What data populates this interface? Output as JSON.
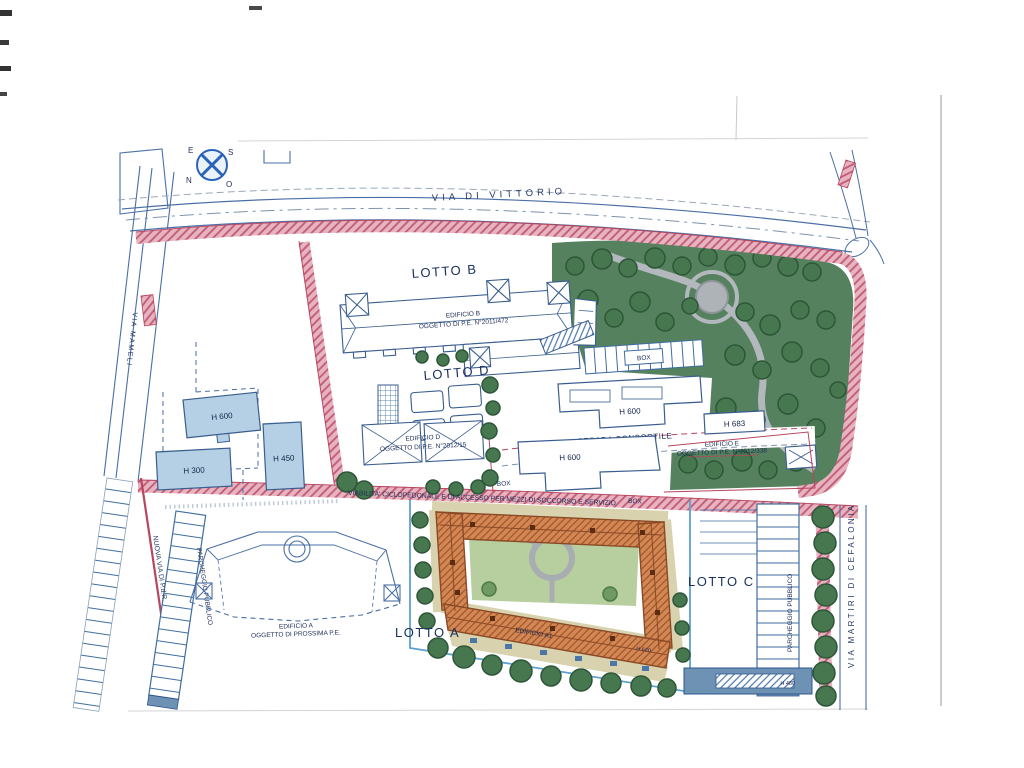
{
  "colors": {
    "ink_blue": "#3a5d8f",
    "faint_ink": "#7d93ad",
    "red_line": "#b8465e",
    "park_green": "#55815f",
    "tree_green": "#47774f",
    "path_pink": "#e6b3c1",
    "existing_building_blue": "#b5d0e4",
    "roof_orange": "#d28756",
    "terrace_tan": "#d9d2ae",
    "courtyard_green": "#b7cf9e",
    "walk_gray": "#b3b8bd",
    "strip_blue": "#6d92b4"
  },
  "compass": {
    "east": "E",
    "south": "S",
    "north": "N",
    "west": "O"
  },
  "streets": {
    "via_di_vittorio": "VIA  DI  VITTORIO",
    "via_mameli": "VIA  MAMELI",
    "nuova_via": "NUOVA  VIA  DI  P.d.R.",
    "via_martiri": "VIA  MARTIRI  DI  CEFALONIA",
    "strada_consortile": "STRADA CONSORTILE",
    "viabilita": "VIABILITA' CICLOPEDONALE E DI ACCESSO PER MEZZI DI SOCCORSO E SERVIZIO"
  },
  "lots": {
    "a": "LOTTO A",
    "b": "LOTTO B",
    "c": "LOTTO C",
    "d": "LOTTO D"
  },
  "buildings": {
    "edificio_a": {
      "line1": "EDIFICIO A",
      "line2": "OGGETTO DI PROSSIMA P.E."
    },
    "edificio_a1": {
      "line1": "EDIFICIO A1"
    },
    "edificio_b": {
      "line1": "EDIFICIO B",
      "line2": "OGGETTO DI P.E. N°2011/472"
    },
    "edificio_d": {
      "line1": "EDIFICIO D",
      "line2": "OGGETTO DI P.E. N°2012/15"
    },
    "edificio_e": {
      "line1": "EDIFICIO E",
      "line2": "OGGETTO DI P.E. N°2012/338"
    }
  },
  "heights": {
    "h300": "H 300",
    "h450": "H 450",
    "h600": "H 600",
    "h620": "H 620",
    "h683": "H 683",
    "h480": "H 480"
  },
  "parking": {
    "parcheggio_pubblico": "PARCHEGGIO PUBBLICO",
    "box": "BOX"
  }
}
